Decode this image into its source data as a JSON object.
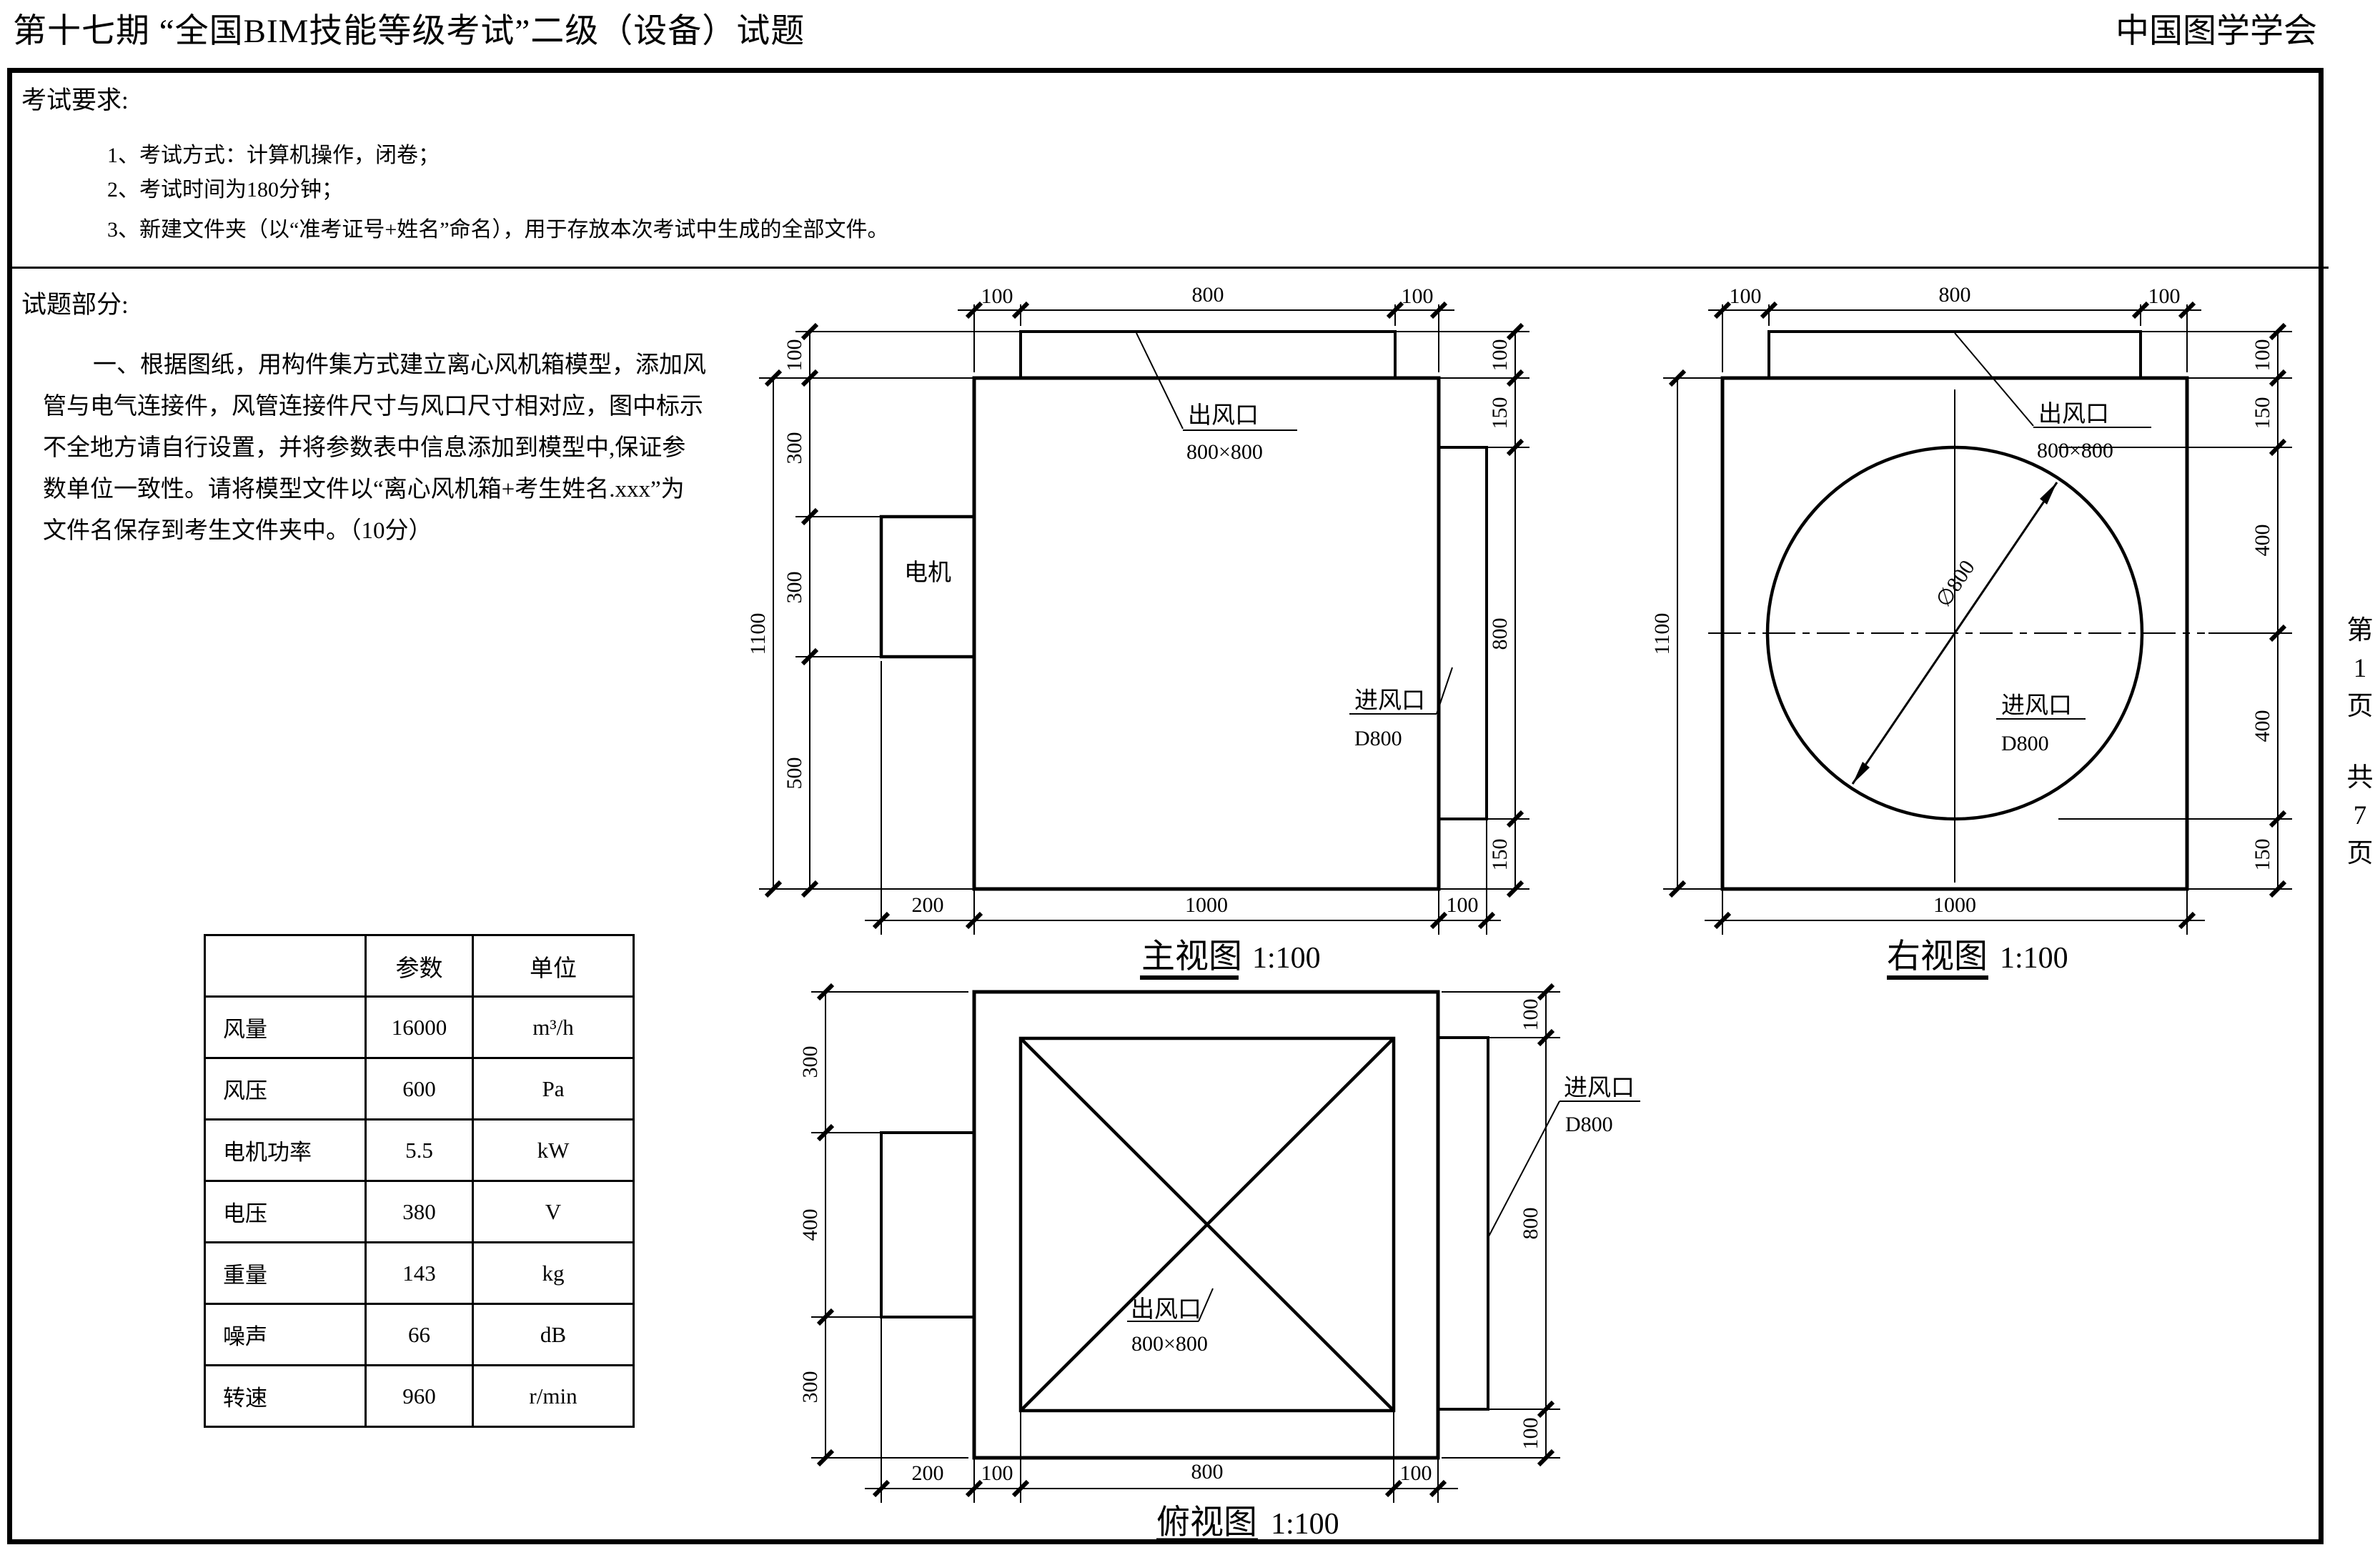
{
  "header": {
    "title": "第十七期 “全国BIM技能等级考试”二级（设备）试题",
    "org": "中国图学学会"
  },
  "requirements": {
    "heading": "考试要求:",
    "items": [
      "1、考试方式：计算机操作，闭卷；",
      "2、考试时间为180分钟；",
      "3、新建文件夹（以“准考证号+姓名”命名），用于存放本次考试中生成的全部文件。"
    ]
  },
  "question": {
    "heading": "试题部分:",
    "para": [
      "一、根据图纸，用构件集方式建立离心风机箱模型，添加风",
      "管与电气连接件，风管连接件尺寸与风口尺寸相对应，图中标示",
      "不全地方请自行设置，并将参数表中信息添加到模型中,保证参",
      "数单位一致性。请将模型文件以“离心风机箱+考生姓名.xxx”为",
      "文件名保存到考生文件夹中。（10分）"
    ]
  },
  "param_table": {
    "headers": [
      "",
      "参数",
      "单位"
    ],
    "rows": [
      [
        "风量",
        "16000",
        "m³/h"
      ],
      [
        "风压",
        "600",
        "Pa"
      ],
      [
        "电机功率",
        "5.5",
        "kW"
      ],
      [
        "电压",
        "380",
        "V"
      ],
      [
        "重量",
        "143",
        "kg"
      ],
      [
        "噪声",
        "66",
        "dB"
      ],
      [
        "转速",
        "960",
        "r/min"
      ]
    ]
  },
  "views": {
    "front": {
      "title": "主视图",
      "scale": "1:100",
      "motor": "电机",
      "outlet": {
        "name": "出风口",
        "size": "800×800"
      },
      "inlet": {
        "name": "进风口",
        "size": "D800"
      },
      "dims": {
        "top": [
          "100",
          "800",
          "100"
        ],
        "left_total": "1100",
        "left": [
          "100",
          "300",
          "300",
          "500"
        ],
        "right": [
          "100",
          "150",
          "800",
          "150"
        ],
        "bottom": [
          "200",
          "1000",
          "100"
        ]
      }
    },
    "right": {
      "title": "右视图",
      "scale": "1:100",
      "outlet": {
        "name": "出风口",
        "size": "800×800"
      },
      "inlet": {
        "name": "进风口",
        "size": "D800"
      },
      "diameter": "∅800",
      "dims": {
        "top": [
          "100",
          "800",
          "100"
        ],
        "left_total": "1100",
        "right": [
          "100",
          "150",
          "400",
          "400",
          "150"
        ],
        "bottom": [
          "1000"
        ]
      }
    },
    "top": {
      "title": "俯视图",
      "scale": "1:100",
      "outlet": {
        "name": "出风口",
        "size": "800×800"
      },
      "inlet": {
        "name": "进风口",
        "size": "D800"
      },
      "dims": {
        "left": [
          "300",
          "400",
          "300"
        ],
        "right": [
          "100",
          "800",
          "100"
        ],
        "bottom": [
          "200",
          "100",
          "800",
          "100"
        ]
      }
    }
  },
  "page_indicator": {
    "current": [
      "第",
      "1",
      "页"
    ],
    "total": [
      "共",
      "7",
      "页"
    ]
  }
}
